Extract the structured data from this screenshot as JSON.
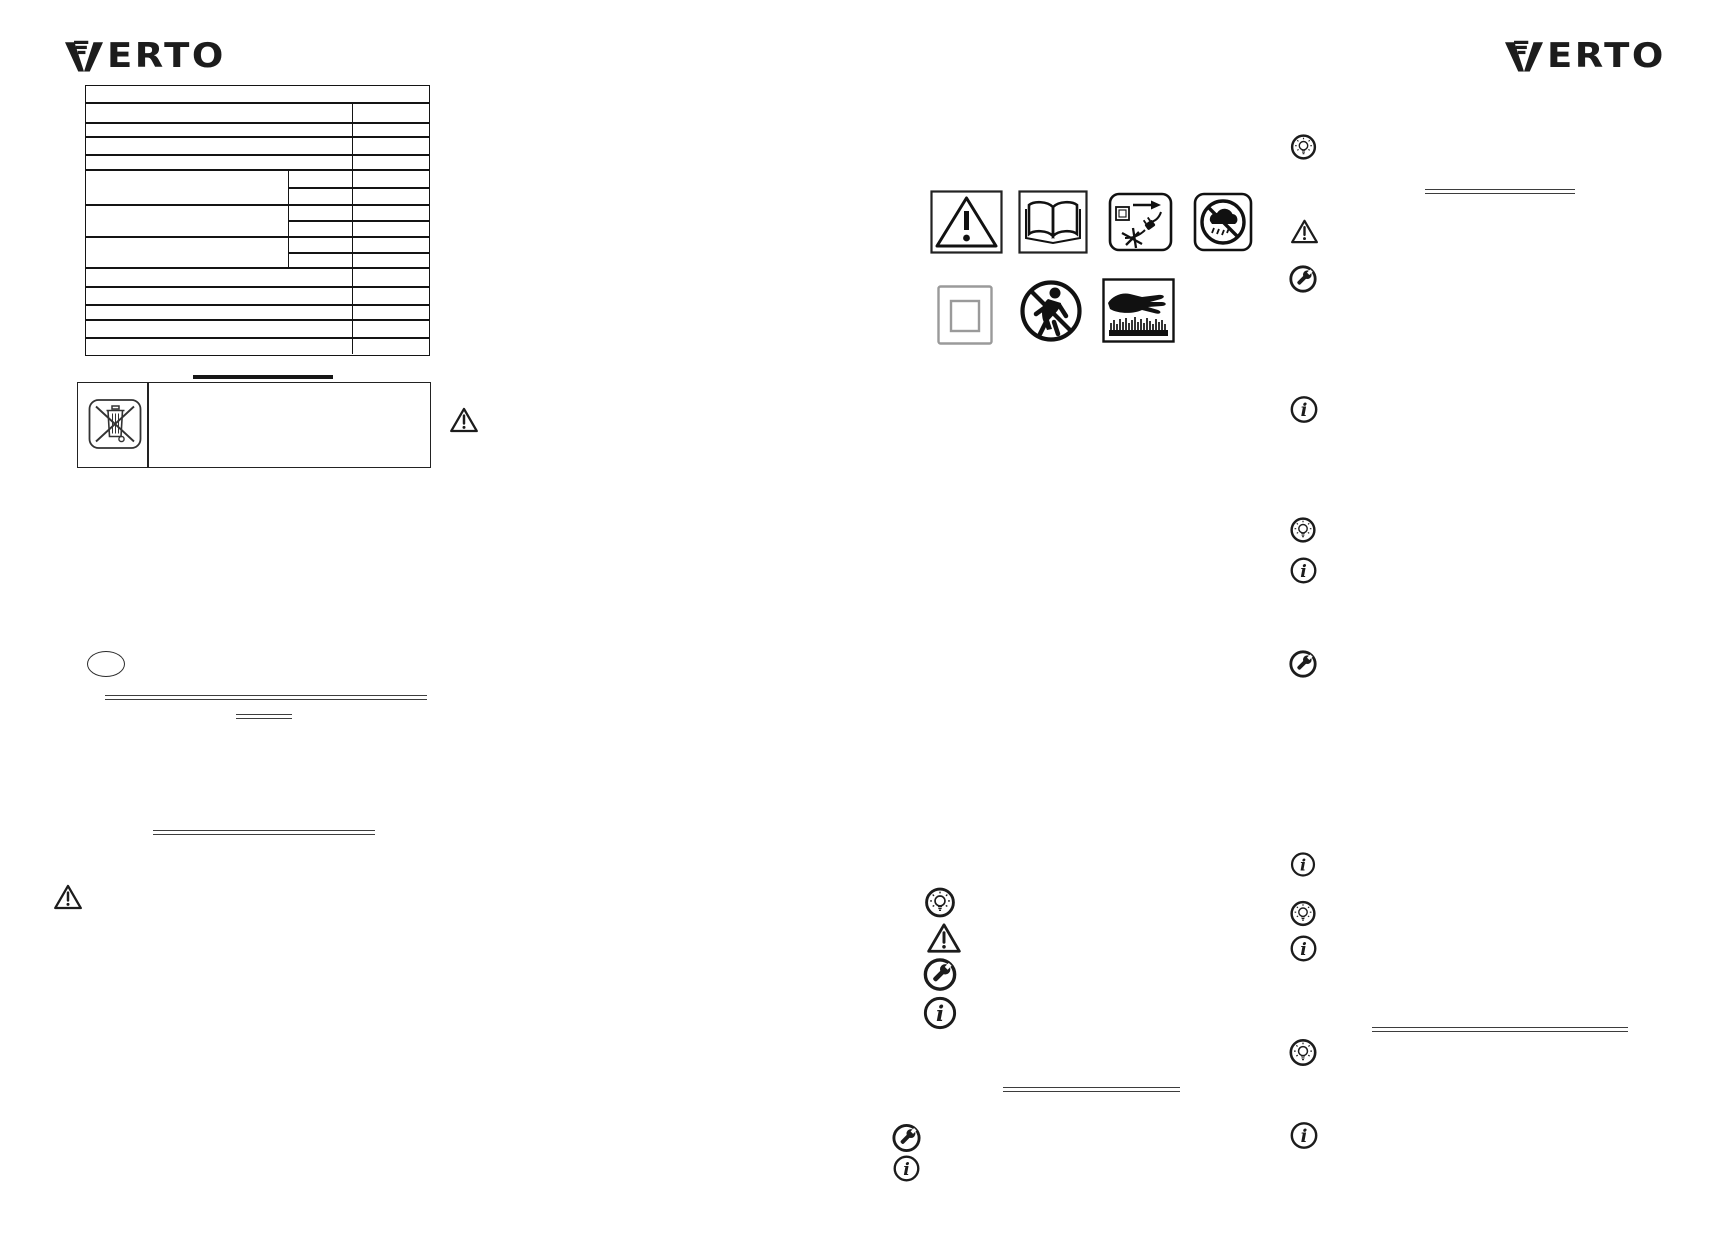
{
  "brand": {
    "logo_text": "VERTO",
    "logo_wordmark_rest": "ERTO"
  },
  "colors": {
    "ink": "#1c1c1c",
    "table_line": "#141414",
    "rule": "#3d3d3d",
    "gray_symbol": "#9a9a9a",
    "page_bg": "#ffffff"
  },
  "safety_pictograms": {
    "row1": [
      "general-warning",
      "read-instruction-manual",
      "unplug-before-maintenance",
      "protect-from-rain"
    ],
    "row2": [
      "class-ii-double-insulation",
      "keep-children-away",
      "sharp-elements-keep-hands-away"
    ]
  },
  "disposal": {
    "symbol": "crossed-out-wheeled-bin"
  },
  "margin_note_icons": {
    "center_column": [
      "tip-bulb",
      "warning-triangle",
      "service-wrench",
      "info",
      "service-wrench",
      "info"
    ],
    "right_column": [
      "tip-bulb",
      "warning-triangle",
      "service-wrench",
      "info",
      "tip-bulb",
      "info",
      "service-wrench",
      "info",
      "tip-bulb",
      "info",
      "tip-bulb",
      "info"
    ]
  }
}
